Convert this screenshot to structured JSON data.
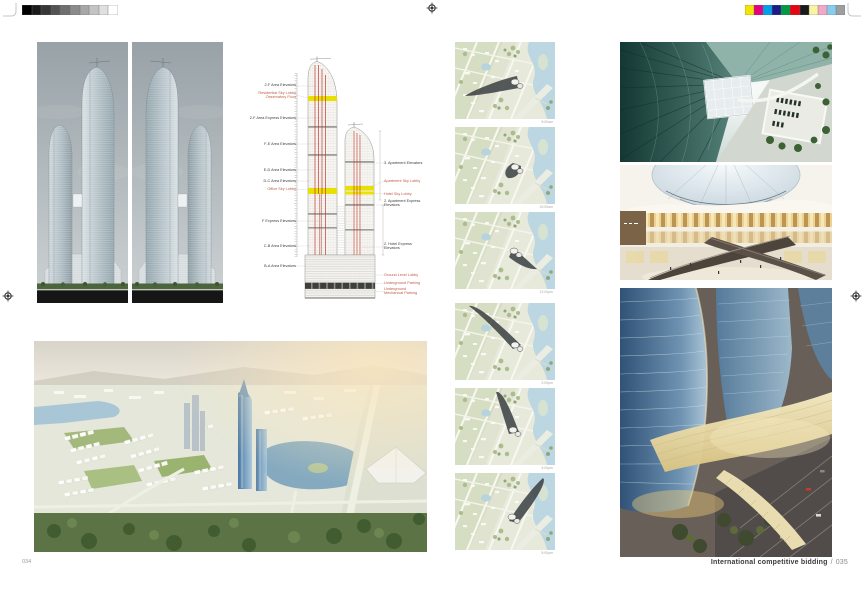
{
  "page": {
    "left_folio": "034",
    "right_folio": "035",
    "footer_title": "International competitive bidding",
    "footer_separator": "/"
  },
  "print_marks": {
    "grayscale_swatches": [
      "#000000",
      "#1b1b1b",
      "#373737",
      "#535353",
      "#6f6f6f",
      "#8b8b8b",
      "#a7a7a7",
      "#c3c3c3",
      "#e0e0e0",
      "#ffffff"
    ],
    "color_swatches": [
      "#f5e400",
      "#e4007f",
      "#00a0e9",
      "#1b1c87",
      "#009a44",
      "#e30613",
      "#1a1a1a",
      "#f8f4a3",
      "#f3a8c8",
      "#87cdee",
      "#9c9e9f"
    ]
  },
  "elevation_diagram": {
    "accent_colors": {
      "sky_lobby_band": "#e8e000",
      "elevator_line": "#c0392b",
      "red_label": "#bf5a47"
    },
    "left_labels": [
      {
        "text": "2-F Area Elevators"
      },
      {
        "text": "Residential Sky Lobby",
        "text2": "Observatory Floor"
      },
      {
        "text": "2-F Area Express Elevators"
      },
      {
        "text": "F-E Area Elevators"
      },
      {
        "text": "E-D Area Elevators"
      },
      {
        "text": "D-C Area Elevators"
      },
      {
        "text": "Office Sky Lobby"
      },
      {
        "text": "F Express Elevators"
      },
      {
        "text": "C-B Area Elevators"
      },
      {
        "text": "B-A Area Elevators"
      }
    ],
    "right_labels": [
      {
        "text": "3. Apartment Elevators"
      },
      {
        "text": "Apartment Sky Lobby"
      },
      {
        "text": "Hotel Sky Lobby"
      },
      {
        "text": "2. Apartment Express",
        "text2": "Elevators"
      },
      {
        "text": "2. Hotel Express",
        "text2": "Elevators"
      },
      {
        "text": "Ground Level Lobby"
      },
      {
        "text": "Underground Parking"
      },
      {
        "text": "Underground",
        "text2": "Mechanical Parking"
      }
    ]
  },
  "shadow_study": {
    "captions": [
      "9:00am",
      "10:00am",
      "12:00pm",
      "2:00pm",
      "4:00pm",
      "5:00pm"
    ]
  }
}
